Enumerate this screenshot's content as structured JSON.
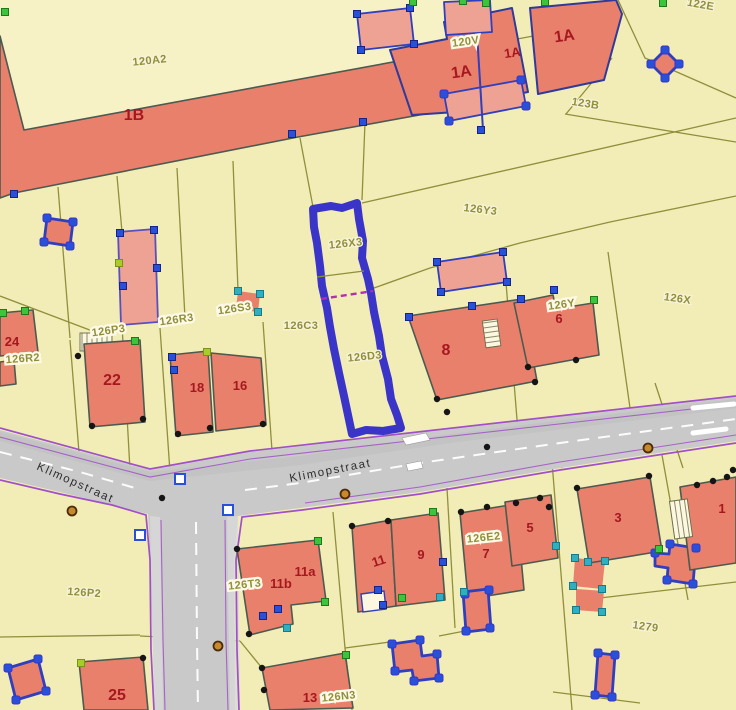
{
  "map": {
    "type": "cadastral parcel map",
    "street_names": [
      "Klimopstraat"
    ],
    "selected_parcel_labels": [
      "126X3",
      "126D3"
    ],
    "labels": [
      {
        "t": "120A2",
        "x": 150,
        "y": 64,
        "r": -6,
        "s": "parcel"
      },
      {
        "t": "1B",
        "x": 134,
        "y": 120,
        "r": 0,
        "s": "houseLg"
      },
      {
        "t": "120V",
        "x": 466,
        "y": 45,
        "r": -8,
        "s": "halo"
      },
      {
        "t": "1A",
        "x": 462,
        "y": 77,
        "r": -8,
        "s": "houseLg"
      },
      {
        "t": "1A",
        "x": 513,
        "y": 57,
        "r": -8,
        "s": "house"
      },
      {
        "t": "1A",
        "x": 565,
        "y": 41,
        "r": -8,
        "s": "houseLg"
      },
      {
        "t": "122E",
        "x": 700,
        "y": 8,
        "r": 10,
        "s": "parcel"
      },
      {
        "t": "123B",
        "x": 585,
        "y": 107,
        "r": 9,
        "s": "parcel"
      },
      {
        "t": "126Y3",
        "x": 480,
        "y": 213,
        "r": 7,
        "s": "parcel"
      },
      {
        "t": "126X3",
        "x": 346,
        "y": 247,
        "r": -6,
        "s": "parcel"
      },
      {
        "t": "126X",
        "x": 677,
        "y": 302,
        "r": 8,
        "s": "parcel"
      },
      {
        "t": "126C3",
        "x": 301,
        "y": 329,
        "r": 0,
        "s": "parcel"
      },
      {
        "t": "126D3",
        "x": 365,
        "y": 360,
        "r": -6,
        "s": "parcel"
      },
      {
        "t": "8",
        "x": 446,
        "y": 355,
        "r": 0,
        "s": "houseLg"
      },
      {
        "t": "126Y",
        "x": 562,
        "y": 308,
        "r": -8,
        "s": "halo"
      },
      {
        "t": "6",
        "x": 559,
        "y": 323,
        "r": 0,
        "s": "house"
      },
      {
        "t": "126S3",
        "x": 235,
        "y": 312,
        "r": -8,
        "s": "halo"
      },
      {
        "t": "126R3",
        "x": 177,
        "y": 323,
        "r": -8,
        "s": "halo"
      },
      {
        "t": "126P3",
        "x": 109,
        "y": 334,
        "r": -8,
        "s": "halo"
      },
      {
        "t": "24",
        "x": 12,
        "y": 346,
        "r": 0,
        "s": "house"
      },
      {
        "t": "126R2",
        "x": 23,
        "y": 362,
        "r": -4,
        "s": "halo"
      },
      {
        "t": "22",
        "x": 112,
        "y": 385,
        "r": 0,
        "s": "houseLg"
      },
      {
        "t": "18",
        "x": 197,
        "y": 392,
        "r": 0,
        "s": "house"
      },
      {
        "t": "16",
        "x": 240,
        "y": 390,
        "r": 0,
        "s": "house"
      },
      {
        "t": "Klimopstraat",
        "x": 74,
        "y": 486,
        "r": 24,
        "s": "street"
      },
      {
        "t": "Klimopstraat",
        "x": 331,
        "y": 474,
        "r": -11,
        "s": "street"
      },
      {
        "t": "126P2",
        "x": 84,
        "y": 596,
        "r": 4,
        "s": "parcel"
      },
      {
        "t": "126T3",
        "x": 245,
        "y": 588,
        "r": -6,
        "s": "halo"
      },
      {
        "t": "11b",
        "x": 281,
        "y": 588,
        "r": 0,
        "s": "house"
      },
      {
        "t": "11a",
        "x": 305,
        "y": 576,
        "r": 0,
        "s": "house"
      },
      {
        "t": "11",
        "x": 380,
        "y": 565,
        "r": -18,
        "s": "house"
      },
      {
        "t": "9",
        "x": 421,
        "y": 559,
        "r": 0,
        "s": "house"
      },
      {
        "t": "126E2",
        "x": 484,
        "y": 541,
        "r": -6,
        "s": "halo"
      },
      {
        "t": "7",
        "x": 486,
        "y": 558,
        "r": 0,
        "s": "house"
      },
      {
        "t": "5",
        "x": 530,
        "y": 532,
        "r": 0,
        "s": "house"
      },
      {
        "t": "3",
        "x": 618,
        "y": 522,
        "r": 0,
        "s": "house"
      },
      {
        "t": "1",
        "x": 722,
        "y": 513,
        "r": 0,
        "s": "house"
      },
      {
        "t": "1279",
        "x": 645,
        "y": 630,
        "r": 8,
        "s": "parcel"
      },
      {
        "t": "25",
        "x": 117,
        "y": 700,
        "r": 0,
        "s": "houseLg"
      },
      {
        "t": "13",
        "x": 310,
        "y": 702,
        "r": 0,
        "s": "house"
      },
      {
        "t": "126N3",
        "x": 339,
        "y": 700,
        "r": -6,
        "s": "halo"
      }
    ],
    "markers": [
      {
        "x": 292,
        "y": 134,
        "t": "b"
      },
      {
        "x": 363,
        "y": 122,
        "t": "b"
      },
      {
        "x": 14,
        "y": 194,
        "t": "b"
      },
      {
        "x": 409,
        "y": 317,
        "t": "b"
      },
      {
        "x": 472,
        "y": 306,
        "t": "b"
      },
      {
        "x": 521,
        "y": 299,
        "t": "b"
      },
      {
        "x": 437,
        "y": 262,
        "t": "b"
      },
      {
        "x": 503,
        "y": 252,
        "t": "b"
      },
      {
        "x": 441,
        "y": 292,
        "t": "b"
      },
      {
        "x": 507,
        "y": 282,
        "t": "b"
      },
      {
        "x": 120,
        "y": 233,
        "t": "b"
      },
      {
        "x": 154,
        "y": 230,
        "t": "b"
      },
      {
        "x": 157,
        "y": 268,
        "t": "b"
      },
      {
        "x": 123,
        "y": 286,
        "t": "b"
      },
      {
        "x": 443,
        "y": 562,
        "t": "b"
      },
      {
        "x": 378,
        "y": 590,
        "t": "b"
      },
      {
        "x": 383,
        "y": 605,
        "t": "b"
      },
      {
        "x": 172,
        "y": 357,
        "t": "b"
      },
      {
        "x": 174,
        "y": 370,
        "t": "b"
      },
      {
        "x": 554,
        "y": 290,
        "t": "b"
      },
      {
        "x": 481,
        "y": 130,
        "t": "b"
      },
      {
        "x": 263,
        "y": 616,
        "t": "b"
      },
      {
        "x": 278,
        "y": 609,
        "t": "b"
      },
      {
        "x": 357,
        "y": 14,
        "t": "b"
      },
      {
        "x": 410,
        "y": 8,
        "t": "b"
      },
      {
        "x": 414,
        "y": 44,
        "t": "b"
      },
      {
        "x": 361,
        "y": 50,
        "t": "b"
      },
      {
        "x": 665,
        "y": 50,
        "t": "o"
      },
      {
        "x": 679,
        "y": 64,
        "t": "o"
      },
      {
        "x": 665,
        "y": 78,
        "t": "o"
      },
      {
        "x": 651,
        "y": 64,
        "t": "o"
      },
      {
        "x": 47,
        "y": 218,
        "t": "o"
      },
      {
        "x": 73,
        "y": 222,
        "t": "o"
      },
      {
        "x": 70,
        "y": 246,
        "t": "o"
      },
      {
        "x": 44,
        "y": 242,
        "t": "o"
      },
      {
        "x": 8,
        "y": 668,
        "t": "o"
      },
      {
        "x": 38,
        "y": 659,
        "t": "o"
      },
      {
        "x": 46,
        "y": 691,
        "t": "o"
      },
      {
        "x": 16,
        "y": 700,
        "t": "o"
      },
      {
        "x": 598,
        "y": 653,
        "t": "o"
      },
      {
        "x": 615,
        "y": 655,
        "t": "o"
      },
      {
        "x": 612,
        "y": 697,
        "t": "o"
      },
      {
        "x": 595,
        "y": 695,
        "t": "o"
      },
      {
        "x": 392,
        "y": 644,
        "t": "o"
      },
      {
        "x": 420,
        "y": 640,
        "t": "o"
      },
      {
        "x": 437,
        "y": 654,
        "t": "o"
      },
      {
        "x": 439,
        "y": 678,
        "t": "o"
      },
      {
        "x": 414,
        "y": 681,
        "t": "o"
      },
      {
        "x": 395,
        "y": 671,
        "t": "o"
      },
      {
        "x": 670,
        "y": 544,
        "t": "o"
      },
      {
        "x": 696,
        "y": 548,
        "t": "o"
      },
      {
        "x": 693,
        "y": 584,
        "t": "o"
      },
      {
        "x": 667,
        "y": 580,
        "t": "o"
      },
      {
        "x": 655,
        "y": 553,
        "t": "o"
      },
      {
        "x": 444,
        "y": 94,
        "t": "o"
      },
      {
        "x": 521,
        "y": 80,
        "t": "o"
      },
      {
        "x": 526,
        "y": 106,
        "t": "o"
      },
      {
        "x": 449,
        "y": 121,
        "t": "o"
      },
      {
        "x": 465,
        "y": 594,
        "t": "o"
      },
      {
        "x": 489,
        "y": 590,
        "t": "o"
      },
      {
        "x": 490,
        "y": 628,
        "t": "o"
      },
      {
        "x": 466,
        "y": 631,
        "t": "o"
      },
      {
        "x": 5,
        "y": 12,
        "t": "g"
      },
      {
        "x": 25,
        "y": 311,
        "t": "g"
      },
      {
        "x": 3,
        "y": 313,
        "t": "g"
      },
      {
        "x": 135,
        "y": 341,
        "t": "g"
      },
      {
        "x": 433,
        "y": 512,
        "t": "g"
      },
      {
        "x": 594,
        "y": 300,
        "t": "g"
      },
      {
        "x": 346,
        "y": 655,
        "t": "g"
      },
      {
        "x": 659,
        "y": 549,
        "t": "g"
      },
      {
        "x": 325,
        "y": 602,
        "t": "g"
      },
      {
        "x": 318,
        "y": 541,
        "t": "g"
      },
      {
        "x": 402,
        "y": 598,
        "t": "g"
      },
      {
        "x": 413,
        "y": 2,
        "t": "g"
      },
      {
        "x": 463,
        "y": 1,
        "t": "g"
      },
      {
        "x": 486,
        "y": 3,
        "t": "g"
      },
      {
        "x": 545,
        "y": 2,
        "t": "g"
      },
      {
        "x": 663,
        "y": 3,
        "t": "g"
      },
      {
        "x": 207,
        "y": 352,
        "t": "l"
      },
      {
        "x": 119,
        "y": 263,
        "t": "l"
      },
      {
        "x": 81,
        "y": 663,
        "t": "l"
      },
      {
        "x": 238,
        "y": 291,
        "t": "c"
      },
      {
        "x": 260,
        "y": 294,
        "t": "c"
      },
      {
        "x": 258,
        "y": 312,
        "t": "c"
      },
      {
        "x": 236,
        "y": 309,
        "t": "c"
      },
      {
        "x": 556,
        "y": 546,
        "t": "c"
      },
      {
        "x": 440,
        "y": 597,
        "t": "c"
      },
      {
        "x": 588,
        "y": 562,
        "t": "c"
      },
      {
        "x": 287,
        "y": 628,
        "t": "c"
      },
      {
        "x": 575,
        "y": 558,
        "t": "c"
      },
      {
        "x": 605,
        "y": 561,
        "t": "c"
      },
      {
        "x": 602,
        "y": 589,
        "t": "c"
      },
      {
        "x": 573,
        "y": 586,
        "t": "c"
      },
      {
        "x": 576,
        "y": 610,
        "t": "c"
      },
      {
        "x": 602,
        "y": 612,
        "t": "c"
      },
      {
        "x": 464,
        "y": 592,
        "t": "c"
      },
      {
        "x": 92,
        "y": 426,
        "t": "k"
      },
      {
        "x": 143,
        "y": 419,
        "t": "k"
      },
      {
        "x": 178,
        "y": 434,
        "t": "k"
      },
      {
        "x": 210,
        "y": 428,
        "t": "k"
      },
      {
        "x": 263,
        "y": 424,
        "t": "k"
      },
      {
        "x": 352,
        "y": 526,
        "t": "k"
      },
      {
        "x": 388,
        "y": 521,
        "t": "k"
      },
      {
        "x": 461,
        "y": 512,
        "t": "k"
      },
      {
        "x": 487,
        "y": 507,
        "t": "k"
      },
      {
        "x": 516,
        "y": 503,
        "t": "k"
      },
      {
        "x": 540,
        "y": 498,
        "t": "k"
      },
      {
        "x": 549,
        "y": 507,
        "t": "k"
      },
      {
        "x": 437,
        "y": 399,
        "t": "k"
      },
      {
        "x": 535,
        "y": 382,
        "t": "k"
      },
      {
        "x": 528,
        "y": 367,
        "t": "k"
      },
      {
        "x": 576,
        "y": 360,
        "t": "k"
      },
      {
        "x": 577,
        "y": 488,
        "t": "k"
      },
      {
        "x": 649,
        "y": 476,
        "t": "k"
      },
      {
        "x": 143,
        "y": 658,
        "t": "k"
      },
      {
        "x": 237,
        "y": 549,
        "t": "k"
      },
      {
        "x": 249,
        "y": 634,
        "t": "k"
      },
      {
        "x": 262,
        "y": 668,
        "t": "k"
      },
      {
        "x": 264,
        "y": 690,
        "t": "k"
      },
      {
        "x": 162,
        "y": 498,
        "t": "k"
      },
      {
        "x": 487,
        "y": 447,
        "t": "k"
      },
      {
        "x": 447,
        "y": 412,
        "t": "k"
      },
      {
        "x": 697,
        "y": 485,
        "t": "k"
      },
      {
        "x": 713,
        "y": 481,
        "t": "k"
      },
      {
        "x": 727,
        "y": 477,
        "t": "k"
      },
      {
        "x": 733,
        "y": 470,
        "t": "k"
      },
      {
        "x": 78,
        "y": 356,
        "t": "k"
      },
      {
        "x": 72,
        "y": 511,
        "t": "n"
      },
      {
        "x": 345,
        "y": 494,
        "t": "n"
      },
      {
        "x": 218,
        "y": 646,
        "t": "n"
      },
      {
        "x": 648,
        "y": 448,
        "t": "n"
      },
      {
        "x": 180,
        "y": 479,
        "t": "x"
      },
      {
        "x": 228,
        "y": 510,
        "t": "x"
      },
      {
        "x": 140,
        "y": 535,
        "t": "x"
      }
    ]
  },
  "colors": {
    "background": "#f2edb6",
    "background_light": "#f6f2c6",
    "building_fill": "#e9806c",
    "building_light_fill": "#eda294",
    "building_stroke": "#4c5a50",
    "navy_stroke": "#2f3a9a",
    "blue_outline": "#2f3fbe",
    "selection_outline": "#3a35c8",
    "road_fill": "#c9c9c9",
    "road_edge": "#a050c8",
    "parcel_line": "#8f8f3c",
    "parcel_label": "#8f8f3c",
    "house_label": "#a5181f",
    "marker_blue": "#2850d8",
    "marker_green": "#3cc43c",
    "marker_lime": "#a8cc28",
    "marker_cyan": "#2fb0c0",
    "marker_black": "#151515",
    "marker_brown": "#c8882e"
  }
}
